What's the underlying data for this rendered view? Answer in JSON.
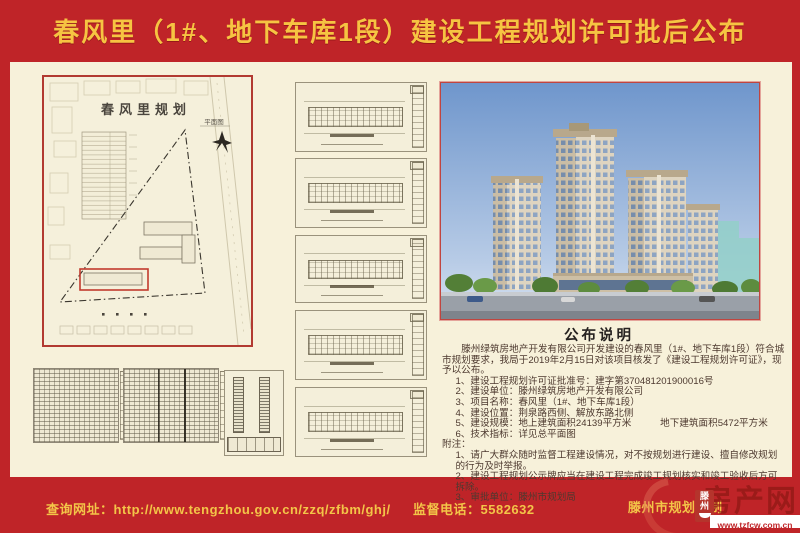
{
  "banner": {
    "title": "春风里（1#、地下车库1段）建设工程规划许可批后公布"
  },
  "site_plan": {
    "title": "春风里规划",
    "label": "平面图"
  },
  "announcement": {
    "heading": "公布说明",
    "intro": "滕州绿筑房地产开发有限公司开发建设的春风里（1#、地下车库1段）符合城市规划要求，我局于2019年2月15日对该项目核发了《建设工程规划许可证》，现予以公布。",
    "items": [
      "1、建设工程规划许可证批准号：建字第370481201900016号",
      "2、建设单位：滕州绿筑房地产开发有限公司",
      "3、项目名称：春风里（1#、地下车库1段）",
      "4、建设位置：荆泉路西侧、解放东路北侧",
      "5、建设规模：地上建筑面积24139平方米　　　地下建筑面积5472平方米",
      "6、技术指标：详见总平面图"
    ],
    "note_heading": "附注：",
    "notes": [
      "1、请广大群众随时监督工程建设情况，对不按规划进行建设、擅自修改规划的行为及时举报。",
      "2、建设工程规划公示牌应当在建设工程完成竣工规划核实和竣工验收后方可拆除。",
      "3、审批单位：滕州市规划局"
    ]
  },
  "footer": {
    "query_label": "查询网址：",
    "query_url": "http://www.tengzhou.gov.cn/zzq/zfbm/ghj/",
    "phone_label": "监督电话：",
    "phone": "5582632",
    "issuer": "滕州市规划局制"
  },
  "watermark": {
    "logo_text": "滕州",
    "site_name": "房产网",
    "site_url": "www.tzfcw.com.cn"
  },
  "colors": {
    "banner_red": "#bf2428",
    "title_yellow": "#f6c442",
    "panel_cream": "#f7f1da",
    "frame_red": "#b23a31"
  }
}
